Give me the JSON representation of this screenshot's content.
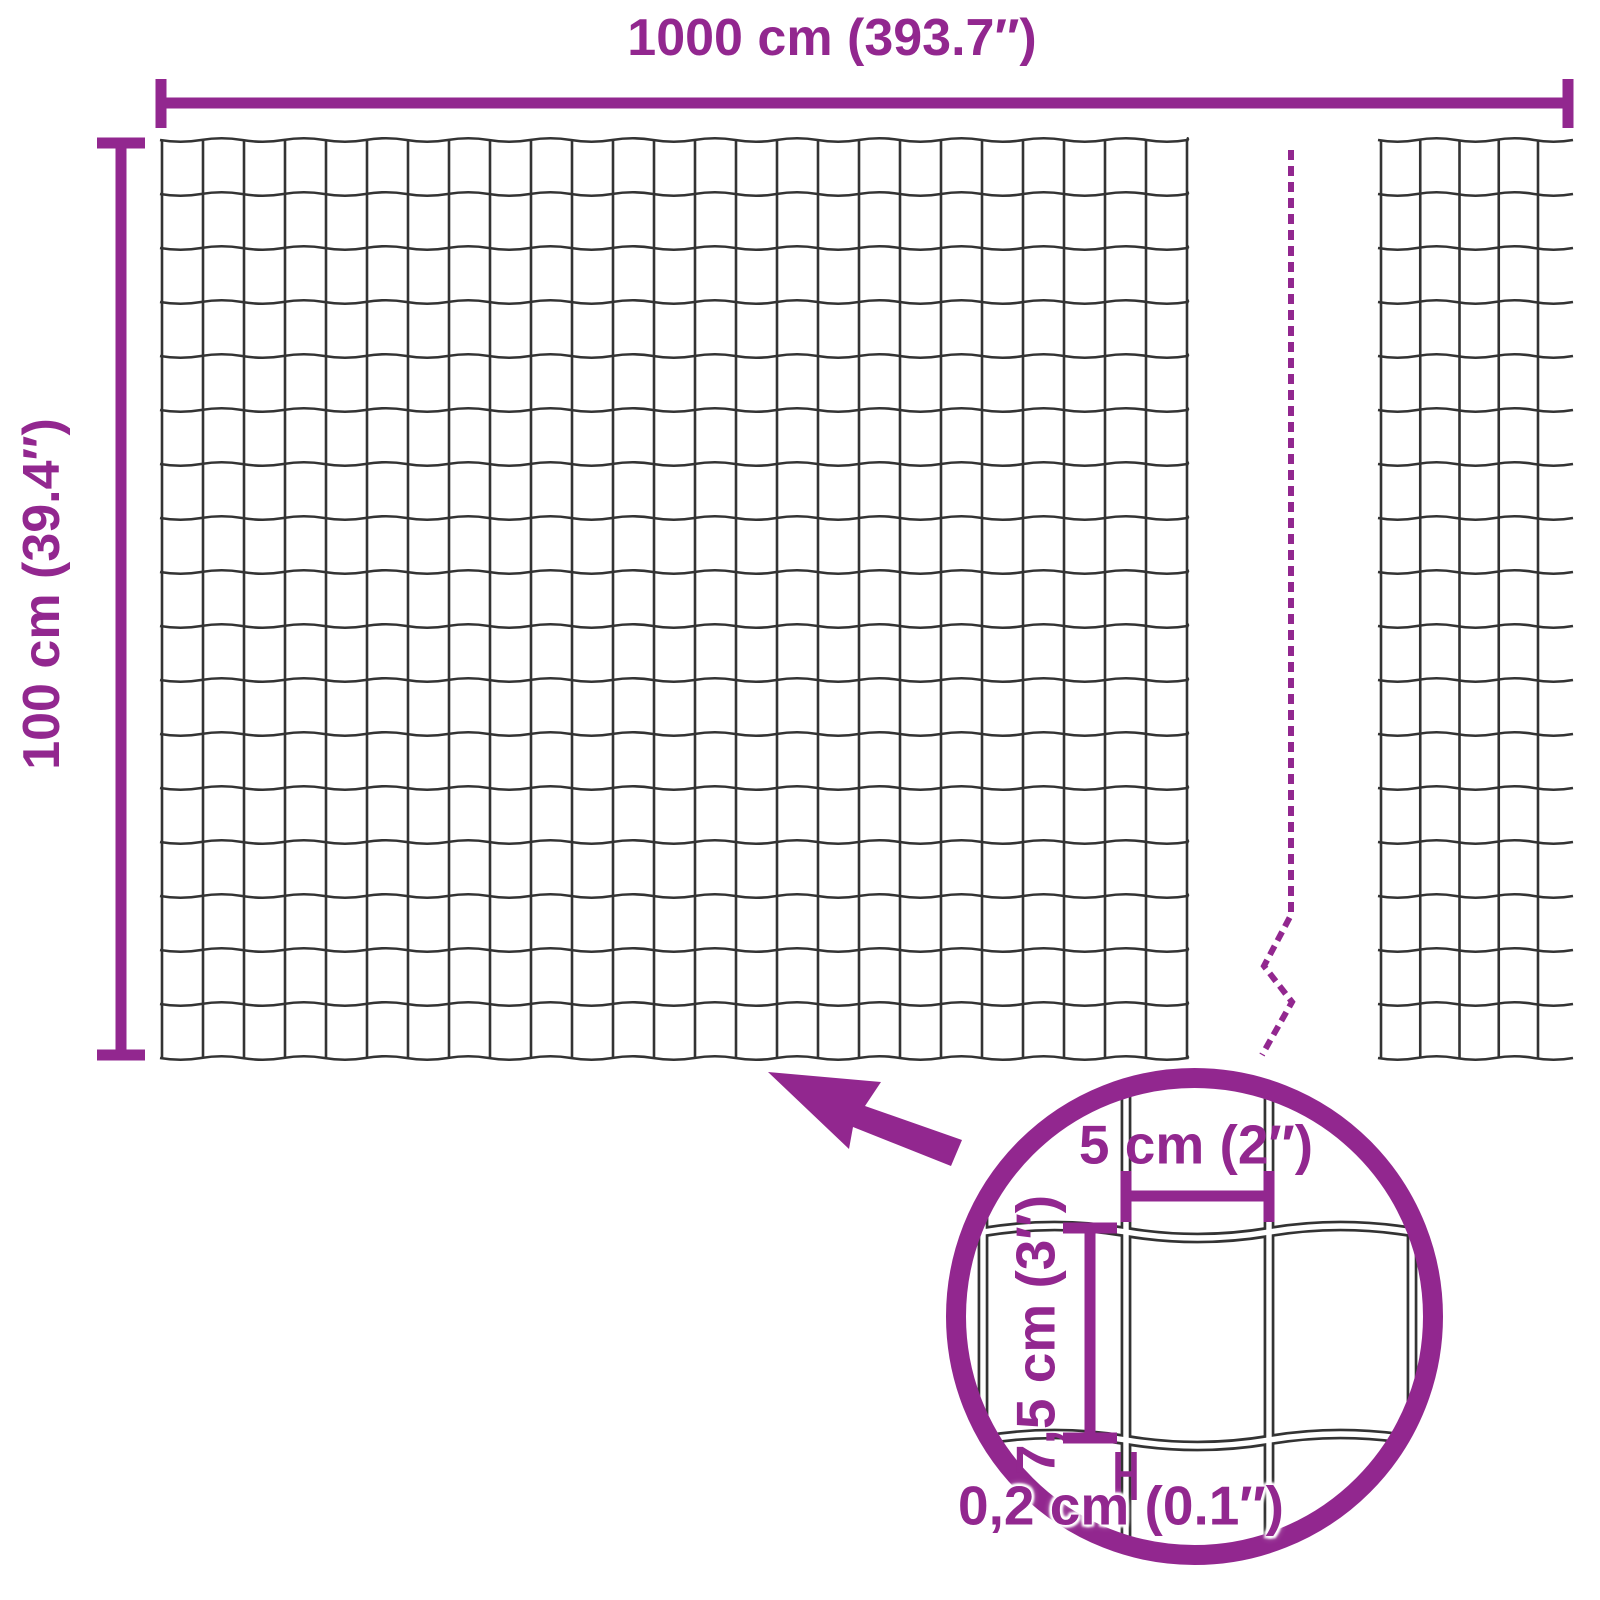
{
  "colors": {
    "accent": "#92278F",
    "wire": "#333333",
    "background": "#FFFFFF"
  },
  "product_diagram": {
    "roll": {
      "width_label": "1000 cm (393.7″)",
      "height_label": "100 cm (39.4″)"
    },
    "mesh_detail": {
      "cell_width_label": "5 cm (2″)",
      "cell_height_label": "7,5 cm (3″)",
      "wire_thickness_label": "0,2 cm (0.1″)"
    }
  },
  "icons": {
    "zoom_arrow": "arrow-pointing-to-mesh",
    "magnifier": "detail-zoom-circle",
    "break_line": "dashed-length-break"
  }
}
